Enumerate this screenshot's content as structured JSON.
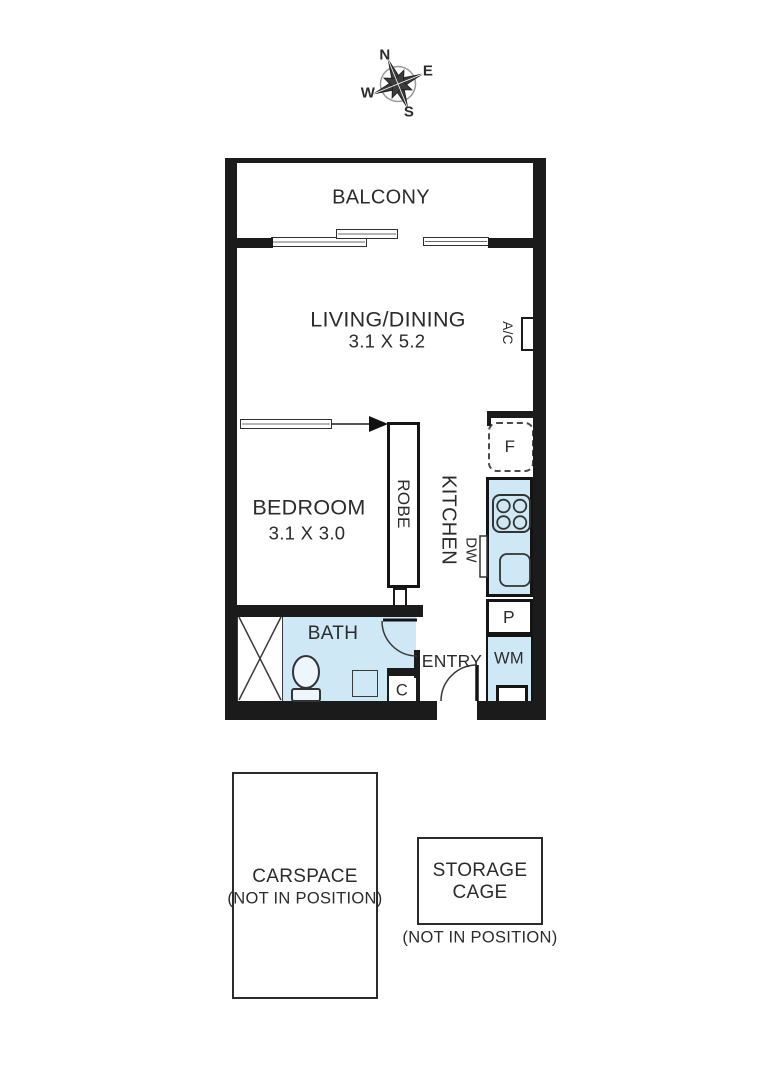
{
  "compass": {
    "n": "N",
    "e": "E",
    "s": "S",
    "w": "W"
  },
  "rooms": {
    "balcony": {
      "label": "BALCONY"
    },
    "living": {
      "label": "LIVING/DINING",
      "dims": "3.1 X 5.2"
    },
    "bedroom": {
      "label": "BEDROOM",
      "dims": "3.1 X 3.0"
    },
    "bath": {
      "label": "BATH"
    },
    "entry": {
      "label": "ENTRY"
    },
    "kitchen": {
      "label": "KITCHEN"
    }
  },
  "fixtures": {
    "robe": "ROBE",
    "air_conditioner": "A/C",
    "fridge": "F",
    "dishwasher": "DW",
    "pantry": "P",
    "washing_machine": "WM",
    "cupboard": "C"
  },
  "outdoor": {
    "carspace": {
      "label": "CARSPACE",
      "note": "(NOT IN POSITION)"
    },
    "storage": {
      "label": "STORAGE CAGE",
      "note": "(NOT IN POSITION)"
    }
  },
  "colors": {
    "wet_area": "#cfe8f5",
    "wall": "#1b1b1b",
    "text": "#2b2b2b"
  }
}
